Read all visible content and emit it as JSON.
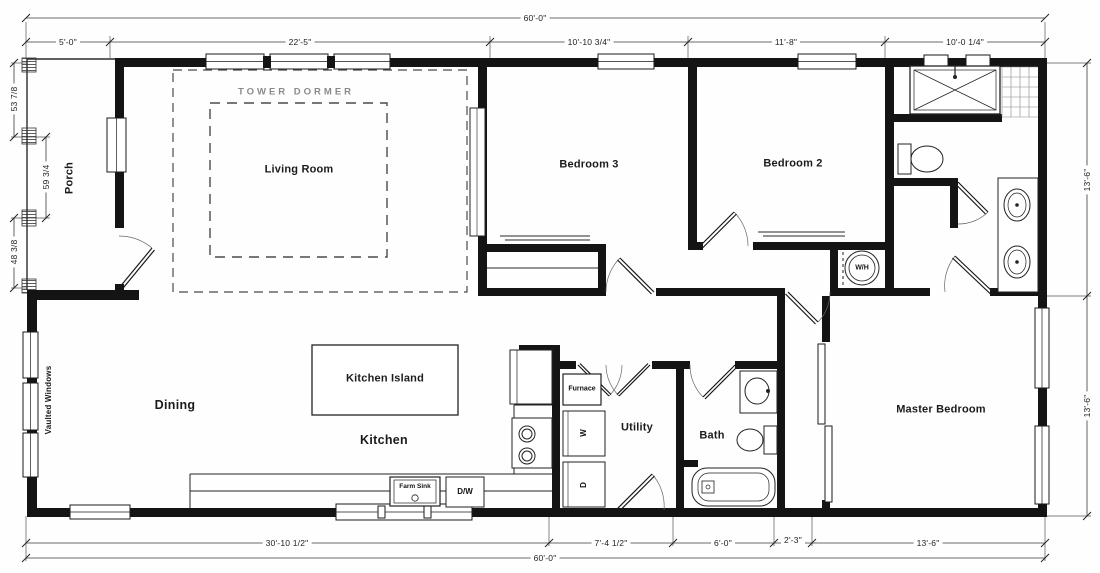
{
  "drawing_title": "Single-story house floor plan",
  "dims": {
    "top_overall": "60'-0\"",
    "top_segments": [
      "5'-0\"",
      "22'-5\"",
      "10'-10 3/4\"",
      "11'-8\"",
      "10'-0 1/4\""
    ],
    "left_segments": [
      "53 7/8",
      "59 3/4",
      "48 3/8"
    ],
    "right_segments": [
      "13'-6\"",
      "13'-6\""
    ],
    "bottom_segments": [
      "30'-10 1/2\"",
      "7'-4 1/2\"",
      "6'-0\"",
      "2'-3\"",
      "13'-6\""
    ],
    "bottom_overall": "60'-0\""
  },
  "rooms": {
    "porch": "Porch",
    "tower_dormer": "TOWER DORMER",
    "living_room": "Living Room",
    "bedroom3": "Bedroom 3",
    "bedroom2": "Bedroom 2",
    "dining": "Dining",
    "kitchen_island": "Kitchen Island",
    "kitchen": "Kitchen",
    "utility": "Utility",
    "bath": "Bath",
    "master_bedroom": "Master Bedroom",
    "vaulted_windows": "Vaulted Windows"
  },
  "fixtures": {
    "furnace": "Furnace",
    "washer": "W",
    "dryer": "D",
    "farm_sink": "Farm Sink",
    "dishwasher": "D/W",
    "water_heater": "W/H"
  },
  "colors": {
    "wall": "#141414",
    "line": "#333333",
    "dim_line": "#3a3a3a",
    "dormer_label": "#8a8a8a",
    "paper": "#fefefe"
  }
}
